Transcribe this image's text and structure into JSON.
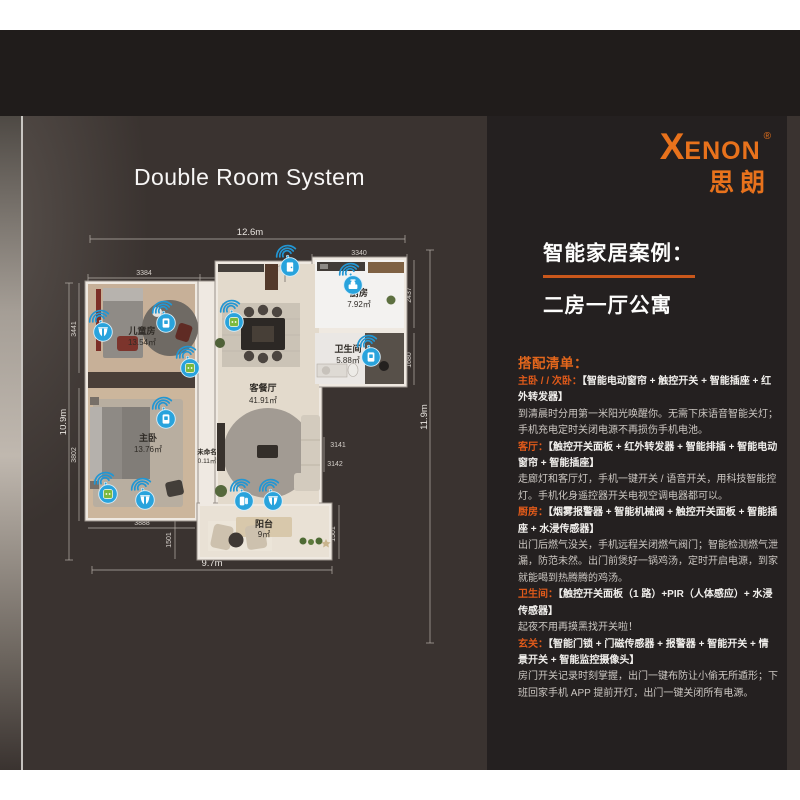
{
  "page": {
    "heading": "Double Room System"
  },
  "brand": {
    "logo_x": "X",
    "logo_rest": "ENON",
    "registered": "®",
    "logo_cn": "思朗",
    "accent": "#e8721c"
  },
  "case_panel": {
    "title": "智能家居案例：",
    "subtitle": "二房一厅公寓",
    "list_heading": "搭配清单：",
    "sections": [
      {
        "label": "主卧 / / 次卧：",
        "devices": "【智能电动窗帘 + 触控开关 + 智能插座 + 红外转发器】",
        "desc": "到清晨时分用第一米阳光唤醒你。无需下床语音智能关灯；手机充电定时关闭电源不再损伤手机电池。"
      },
      {
        "label": "客厅：",
        "devices": "【触控开关面板 + 红外转发器 + 智能排插 + 智能电动窗帘 + 智能插座】",
        "desc": "走廊灯和客厅灯，手机一键开关 / 语音开关，用科技智能控灯。手机化身遥控器开关电视空调电器都可以。"
      },
      {
        "label": "厨房：",
        "devices": "【烟雾报警器 + 智能机械阀 + 触控开关面板 + 智能插座 + 水浸传感器】",
        "desc": "出门后燃气没关，手机远程关闭燃气阀门；智能检测燃气泄漏，防范未然。出门前煲好一锅鸡汤，定时开启电源，到家就能喝到热腾腾的鸡汤。"
      },
      {
        "label": "卫生间：",
        "devices": "【触控开关面板（1 路）+PIR（人体感应）+ 水浸传感器】",
        "desc": "起夜不用再摸黑找开关啦！"
      },
      {
        "label": "玄关：",
        "devices": "【智能门锁 + 门磁传感器 + 报警器 + 智能开关 + 情景开关 + 智能监控摄像头】",
        "desc": "房门开关记录时刻掌握，出门一键布防让小偷无所遁形；下班回家手机 APP 提前开灯，出门一键关闭所有电源。"
      }
    ]
  },
  "floorplan": {
    "rooms": [
      {
        "name": "儿童房",
        "area": "13.54㎡"
      },
      {
        "name": "主卧",
        "area": "13.76㎡"
      },
      {
        "name": "未命名",
        "area": "0.11㎡"
      },
      {
        "name": "客餐厅",
        "area": "41.91㎡"
      },
      {
        "name": "厨房",
        "area": "7.92㎡"
      },
      {
        "name": "卫生间",
        "area": "5.88㎡"
      },
      {
        "name": "阳台",
        "area": "9㎡"
      }
    ],
    "overall_dims": {
      "top": "12.6m",
      "left": "10.9m",
      "right": "11.9m",
      "bottom": "9.7m"
    },
    "segment_dims": {
      "top_1": "3384",
      "top_2": "2747",
      "top_3": "1081",
      "top_right": "3340",
      "left_1": "3441",
      "left_2": "3802",
      "right_1": "2437",
      "right_2": "1680",
      "mid_1": "3141",
      "mid_2": "3142",
      "mid_3": "304",
      "bottom_1": "3888",
      "bal_left": "1501",
      "bal_right": "1501"
    },
    "icons": [
      {
        "name": "curtain-motor-childroom",
        "glyph": "curtain",
        "x": 43,
        "y": 107
      },
      {
        "name": "touch-switch-childroom",
        "glyph": "switch",
        "x": 106,
        "y": 98
      },
      {
        "name": "smart-socket-childroom",
        "glyph": "socket",
        "x": 130,
        "y": 143
      },
      {
        "name": "smart-socket-dining",
        "glyph": "socket",
        "x": 174,
        "y": 97
      },
      {
        "name": "door-lock-entry",
        "glyph": "door",
        "x": 230,
        "y": 42
      },
      {
        "name": "gas-valve-kitchen",
        "glyph": "valve",
        "x": 293,
        "y": 60
      },
      {
        "name": "touch-switch-bathroom",
        "glyph": "switch",
        "x": 311,
        "y": 132
      },
      {
        "name": "touch-switch-master",
        "glyph": "switch",
        "x": 106,
        "y": 194
      },
      {
        "name": "smart-socket-master",
        "glyph": "socket",
        "x": 48,
        "y": 269
      },
      {
        "name": "curtain-motor-master",
        "glyph": "curtain",
        "x": 85,
        "y": 275
      },
      {
        "name": "door-sensor-balcony",
        "glyph": "sensor",
        "x": 184,
        "y": 276
      },
      {
        "name": "curtain-motor-balcony",
        "glyph": "curtain",
        "x": 213,
        "y": 276
      }
    ],
    "colors": {
      "device_blue": "#29a3dc",
      "socket_green": "#7cb93e"
    }
  },
  "theme": {
    "accent_orange": "#e8721c",
    "label_orange": "#e05a1a",
    "panel_bg": "#242020",
    "canvas_bg": "#3a3330"
  }
}
